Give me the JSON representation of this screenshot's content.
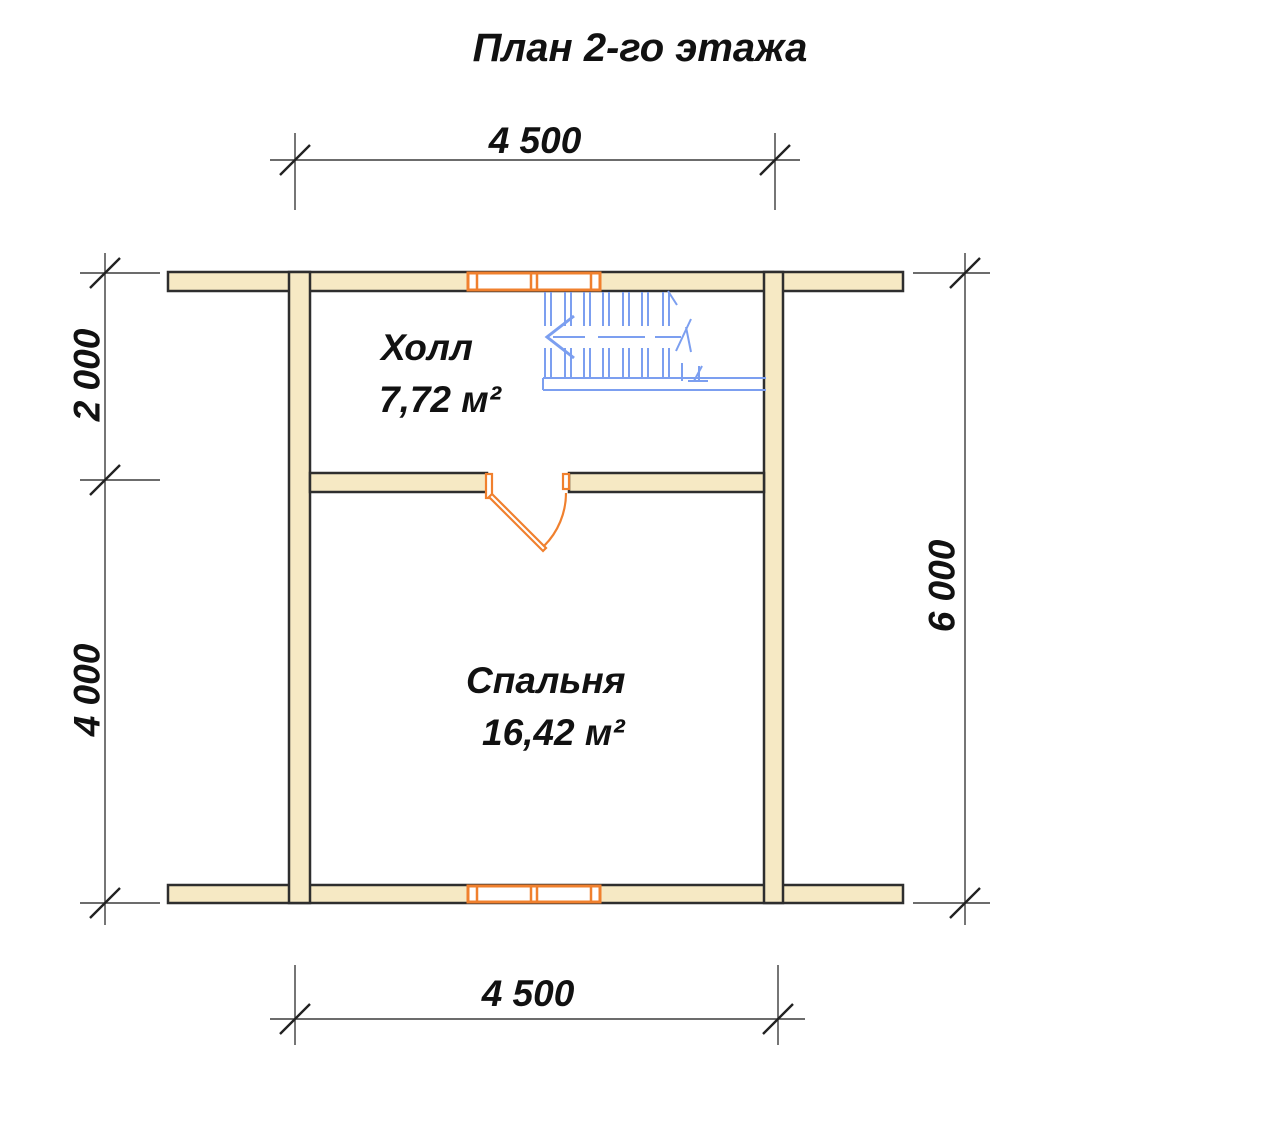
{
  "title": "План 2-го этажа",
  "dimensions": {
    "width_top": "4 500",
    "width_bottom": "4 500",
    "hall_depth": "2 000",
    "bedroom_depth": "4 000",
    "total_depth": "6 000"
  },
  "rooms": {
    "hall": {
      "name": "Холл",
      "area": "7,72 м²"
    },
    "bedroom": {
      "name": "Спальня",
      "area": "16,42 м²"
    }
  },
  "colors": {
    "background": "#ffffff",
    "wall_fill": "#f6e9c4",
    "wall_outline": "#2e2e2e",
    "joinery_orange": "#f0802e",
    "stairs_blue": "#7c9ff0",
    "dimension_line": "#3c3c3c",
    "text": "#111111"
  }
}
